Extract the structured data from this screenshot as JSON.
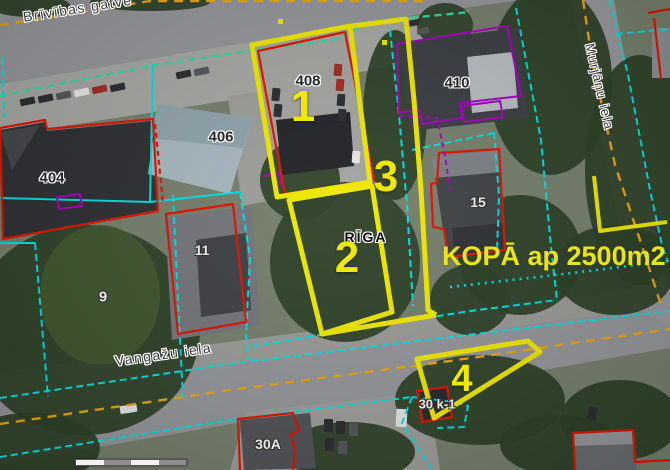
{
  "map": {
    "city_watermark": "RĪGA",
    "annotation_total": "KOPĀ ap 2500m2",
    "streets": {
      "brivibas": "Brīvības gatve",
      "vangazu": "Vangažu iela",
      "murjanu": "Murjāņu iela"
    },
    "house_numbers": {
      "h404": "404",
      "h406": "406",
      "h408": "408",
      "h410": "410",
      "h9": "9",
      "h11": "11",
      "h15": "15",
      "h30a": "30A",
      "h30k1": "30 k-1"
    },
    "parcel_numbers": {
      "p1": "1",
      "p2": "2",
      "p3": "3",
      "p4": "4"
    },
    "palette": {
      "parcel-highlight": "#f0e800",
      "label-yellow": "#e9e41c",
      "boundary-cyan": "#00e0e0",
      "boundary-red": "#e01400",
      "boundary-purple": "#a800c0",
      "boundary-green": "#2fd9a0",
      "road-orange": "#eda310"
    }
  }
}
